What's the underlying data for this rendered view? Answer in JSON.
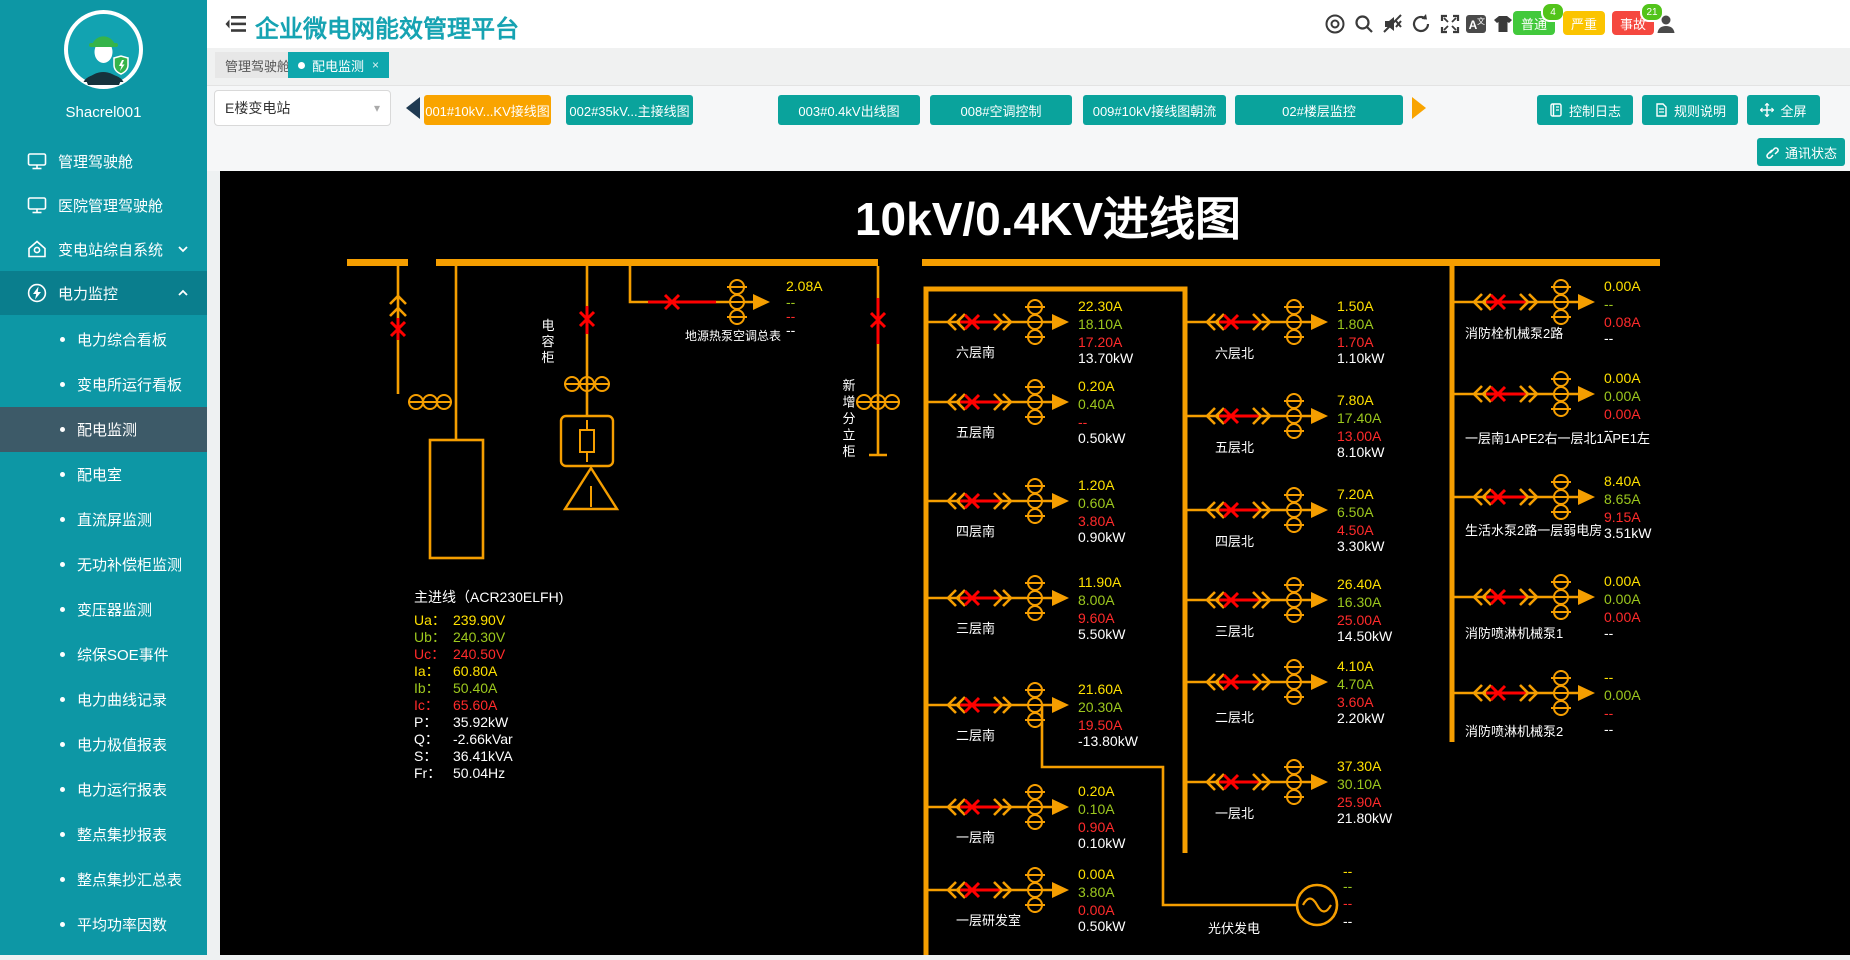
{
  "sidebar": {
    "username": "Shacrel001",
    "items": [
      {
        "label": "管理驾驶舱",
        "icon": "monitor"
      },
      {
        "label": "医院管理驾驶舱",
        "icon": "monitor"
      },
      {
        "label": "变电站综自系统",
        "icon": "home",
        "chevron": "down"
      },
      {
        "label": "电力监控",
        "icon": "power",
        "chevron": "up",
        "active": true
      }
    ],
    "subitems": [
      "电力综合看板",
      "变电所运行看板",
      "配电监测",
      "配电室",
      "直流屏监测",
      "无功补偿柜监测",
      "变压器监测",
      "综保SOE事件",
      "电力曲线记录",
      "电力极值报表",
      "电力运行报表",
      "整点集抄报表",
      "整点集抄汇总表",
      "平均功率因数"
    ],
    "selected_subitem": "配电监测"
  },
  "header": {
    "title": "企业微电网能效管理平台",
    "icons": [
      "help-circle",
      "search",
      "sound-muted",
      "refresh",
      "fullscreen",
      "translate",
      "theme-skin",
      "user"
    ],
    "alarms": [
      {
        "label": "普通",
        "count": "4",
        "color": "#42c93c"
      },
      {
        "label": "严重",
        "count": "",
        "color": "#fbc400"
      },
      {
        "label": "事故",
        "count": "21",
        "color": "#f5483f"
      }
    ]
  },
  "page_tabs": [
    {
      "label": "管理驾驶舱",
      "active": false
    },
    {
      "label": "配电监测",
      "active": true
    }
  ],
  "toolbar": {
    "station": "E楼变电站",
    "diagram_tabs": [
      {
        "label": "001#10kV...KV接线图",
        "active": true
      },
      {
        "label": "002#35kV...主接线图",
        "active": false
      },
      {
        "label": "003#0.4kV出线图",
        "active": false
      },
      {
        "label": "008#空调控制",
        "active": false
      },
      {
        "label": "009#10kV接线图朝流",
        "active": false
      },
      {
        "label": "02#楼层监控",
        "active": false
      }
    ],
    "actions": [
      "控制日志",
      "规则说明",
      "全屏"
    ],
    "comm_status": "通讯状态"
  },
  "diagram": {
    "title": "10kV/0.4KV进线图",
    "colors": {
      "orange": "#F59E00",
      "red_line": "#E60000",
      "yellow": "#FFE100",
      "green": "#9DC81E",
      "red": "#FF2B2B",
      "white": "#FFFFFF"
    },
    "vertical_labels": {
      "capacitor": "电容柜",
      "new_cabinet": "新增分立柜"
    },
    "main_meter": {
      "name": "主进线（ACR230ELFH)",
      "rows": [
        {
          "label": "Ua",
          "value": "239.90V",
          "color": "yellow"
        },
        {
          "label": "Ub",
          "value": "240.30V",
          "color": "green"
        },
        {
          "label": "Uc",
          "value": "240.50V",
          "color": "red"
        },
        {
          "label": "Ia",
          "value": "60.80A",
          "color": "yellow"
        },
        {
          "label": "Ib",
          "value": "50.40A",
          "color": "green"
        },
        {
          "label": "Ic",
          "value": "65.60A",
          "color": "red"
        },
        {
          "label": "P",
          "value": "35.92kW",
          "color": "white"
        },
        {
          "label": "Q",
          "value": "-2.66kVar",
          "color": "white"
        },
        {
          "label": "S",
          "value": "36.41kVA",
          "color": "white"
        },
        {
          "label": "Fr",
          "value": "50.04Hz",
          "color": "white"
        }
      ]
    },
    "heat_pump": {
      "label": "地源热泵空调总表",
      "values": [
        "2.08A",
        "--",
        "--",
        "--"
      ]
    },
    "pv": {
      "label": "光伏发电",
      "values": [
        "--",
        "--",
        "--",
        "--"
      ]
    },
    "columns": [
      {
        "name": "south",
        "branches": [
          {
            "label": "六层南",
            "values": [
              "22.30A",
              "18.10A",
              "17.20A",
              "13.70kW"
            ]
          },
          {
            "label": "五层南",
            "values": [
              "0.20A",
              "0.40A",
              "--",
              "0.50kW"
            ]
          },
          {
            "label": "四层南",
            "values": [
              "1.20A",
              "0.60A",
              "3.80A",
              "0.90kW"
            ]
          },
          {
            "label": "三层南",
            "values": [
              "11.90A",
              "8.00A",
              "9.60A",
              "5.50kW"
            ]
          },
          {
            "label": "二层南",
            "values": [
              "21.60A",
              "20.30A",
              "19.50A",
              "-13.80kW"
            ]
          },
          {
            "label": "一层南",
            "values": [
              "0.20A",
              "0.10A",
              "0.90A",
              "0.10kW"
            ]
          },
          {
            "label": "一层研发室",
            "values": [
              "0.00A",
              "3.80A",
              "0.00A",
              "0.50kW"
            ]
          }
        ]
      },
      {
        "name": "north",
        "branches": [
          {
            "label": "六层北",
            "values": [
              "1.50A",
              "1.80A",
              "1.70A",
              "1.10kW"
            ]
          },
          {
            "label": "五层北",
            "values": [
              "7.80A",
              "17.40A",
              "13.00A",
              "8.10kW"
            ]
          },
          {
            "label": "四层北",
            "values": [
              "7.20A",
              "6.50A",
              "4.50A",
              "3.30kW"
            ]
          },
          {
            "label": "三层北",
            "values": [
              "26.40A",
              "16.30A",
              "25.00A",
              "14.50kW"
            ]
          },
          {
            "label": "二层北",
            "values": [
              "4.10A",
              "4.70A",
              "3.60A",
              "2.20kW"
            ]
          },
          {
            "label": "一层北",
            "values": [
              "37.30A",
              "30.10A",
              "25.90A",
              "21.80kW"
            ]
          }
        ]
      },
      {
        "name": "pumps",
        "branches": [
          {
            "label": "消防栓机械泵2路",
            "values": [
              "0.00A",
              "--",
              "0.08A",
              "--"
            ]
          },
          {
            "label": "一层南1APE2右一层北1APE1左",
            "values": [
              "0.00A",
              "0.00A",
              "0.00A",
              "--"
            ]
          },
          {
            "label": "生活水泵2路一层弱电房",
            "values": [
              "8.40A",
              "8.65A",
              "9.15A",
              "3.51kW"
            ]
          },
          {
            "label": "消防喷淋机械泵1",
            "values": [
              "0.00A",
              "0.00A",
              "0.00A",
              "--"
            ]
          },
          {
            "label": "消防喷淋机械泵2",
            "values": [
              "--",
              "0.00A",
              "--",
              "--"
            ]
          }
        ]
      }
    ]
  }
}
